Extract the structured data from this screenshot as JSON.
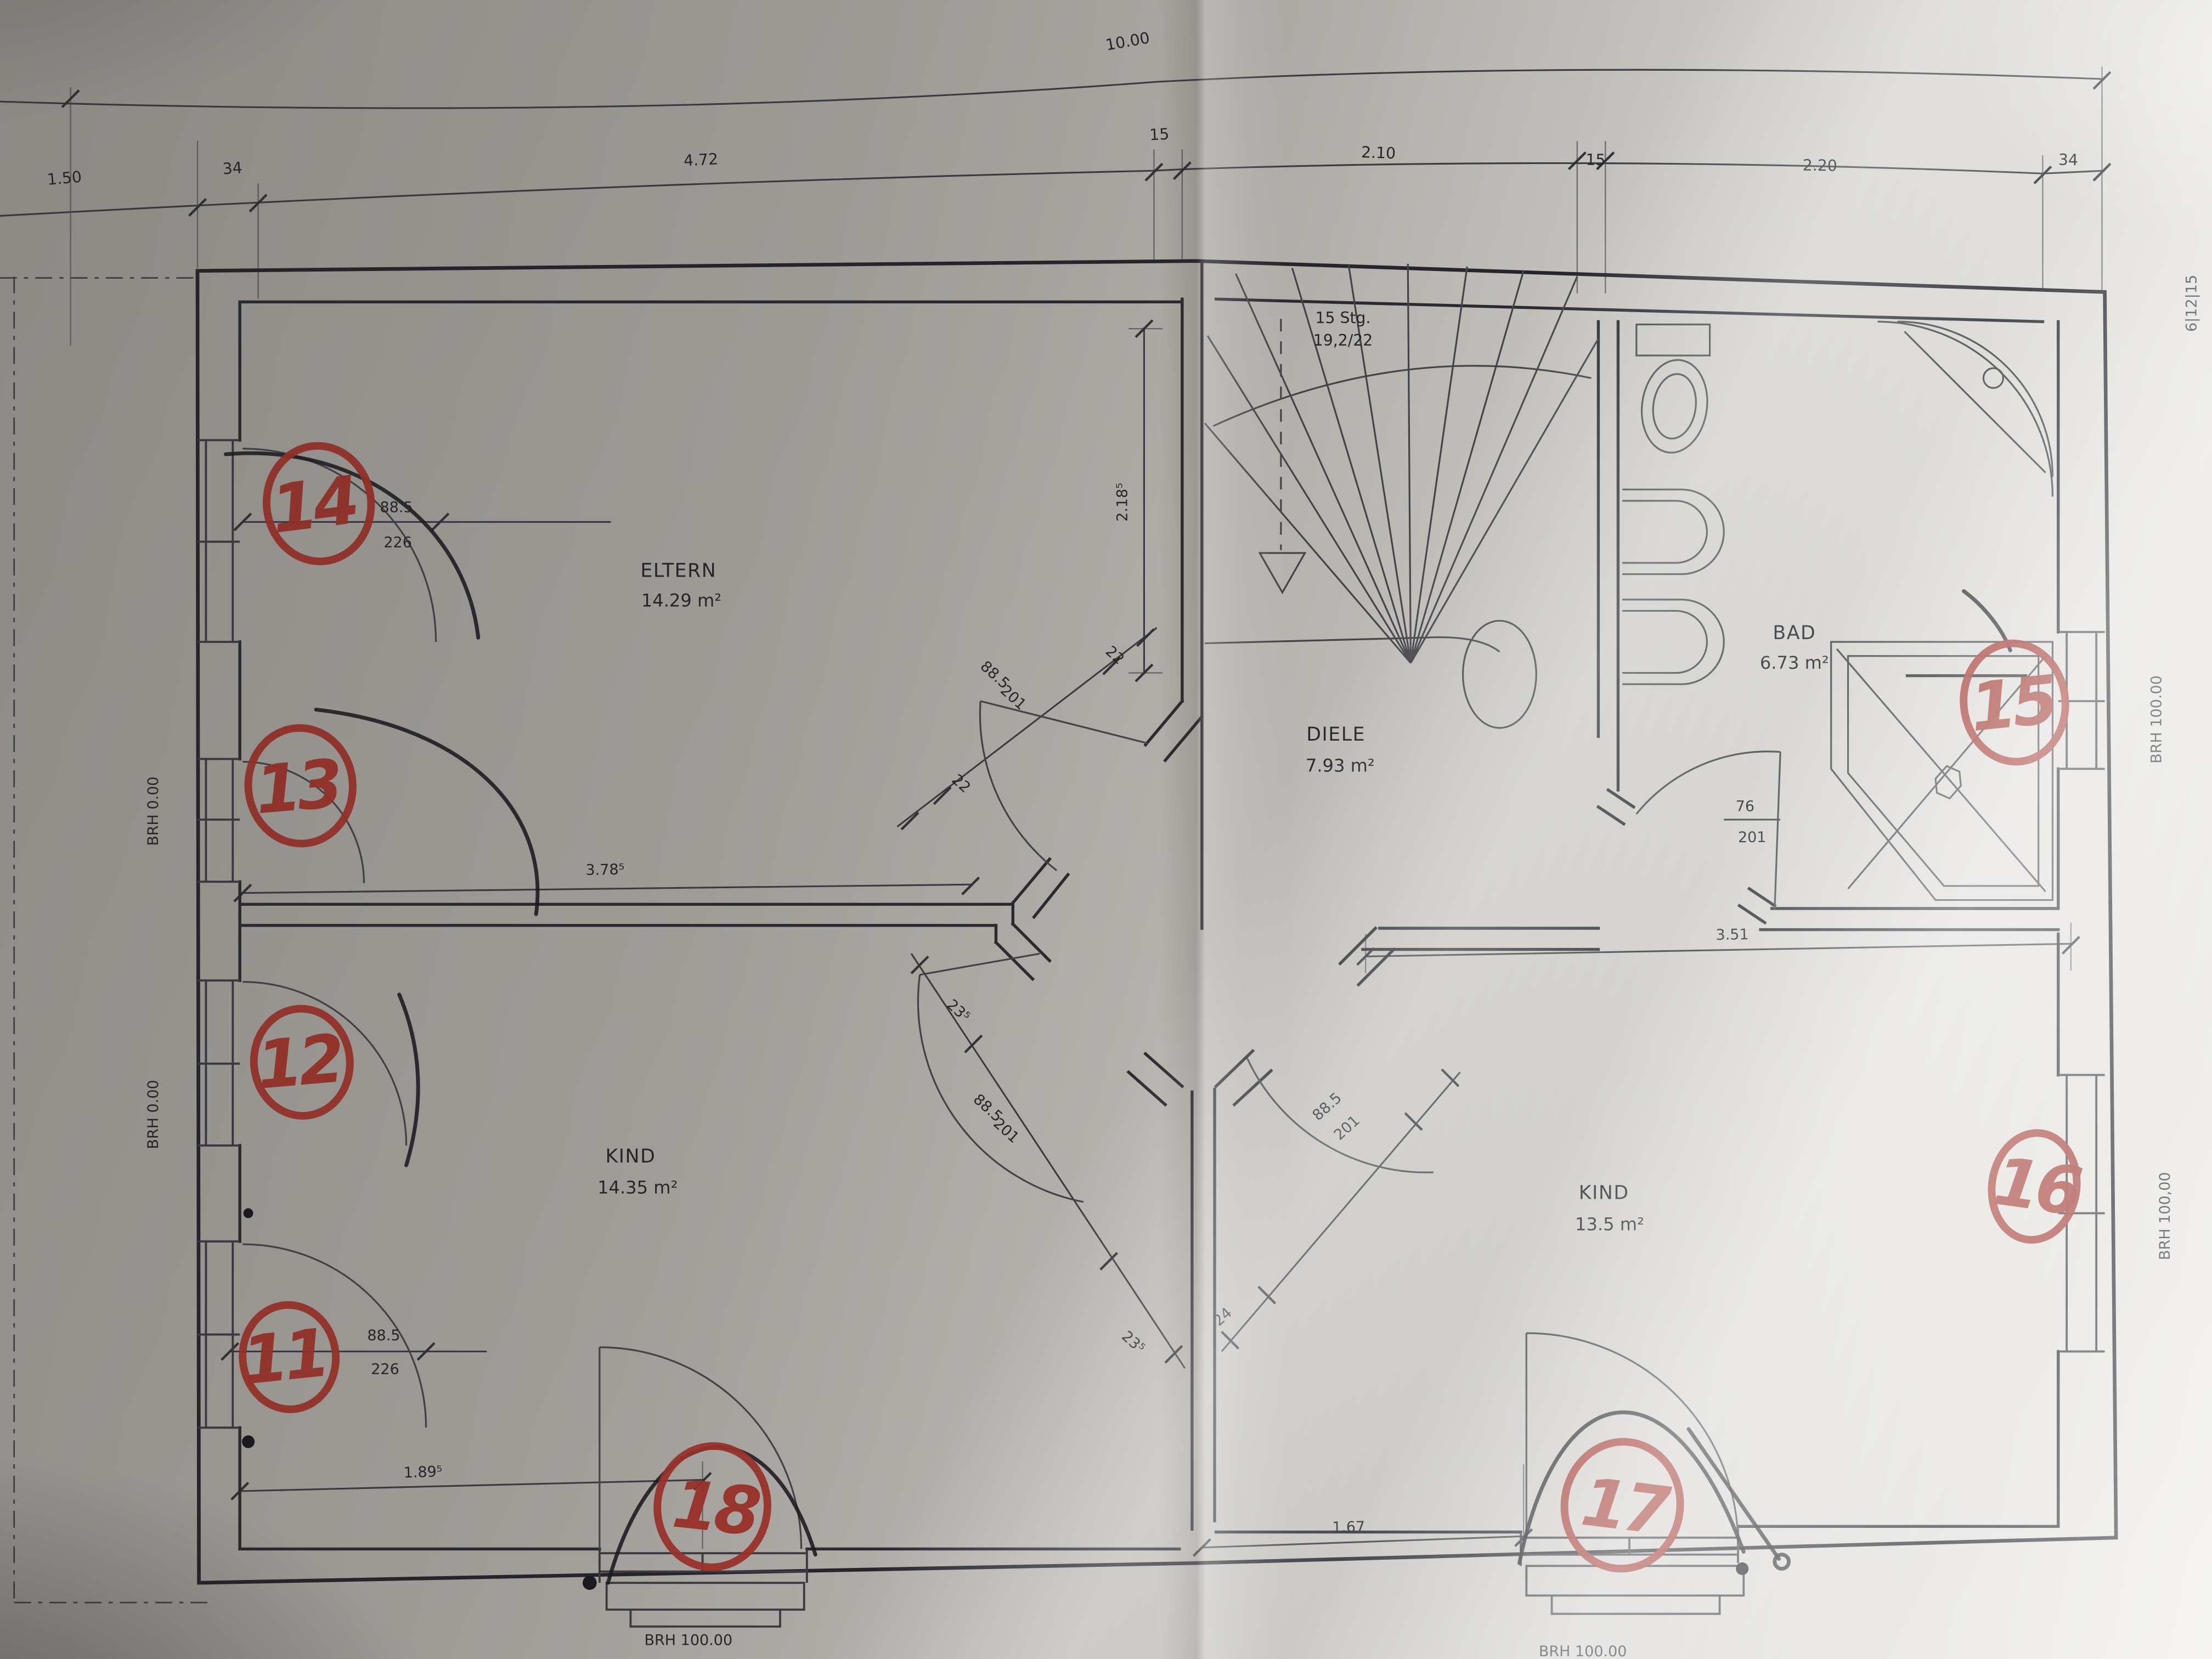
{
  "dims": {
    "total": "10.00",
    "left_offset": "1.50",
    "wall_34": "34",
    "span_472": "4.72",
    "wall_15": "15",
    "span_210": "2.10",
    "span_220": "2.20",
    "eltern_w": "3.78⁵",
    "eltern_h": "2.18⁵",
    "kind2_w": "3.51",
    "kind1_bottom": "1.89⁵",
    "kind2_bottom": "1.67",
    "jamb22": "22",
    "jamb235": "23⁵",
    "jamb24": "24"
  },
  "rooms": {
    "eltern": {
      "name": "ELTERN",
      "area": "14.29 m²"
    },
    "diele": {
      "name": "DIELE",
      "area": "7.93 m²"
    },
    "bad": {
      "name": "BAD",
      "area": "6.73 m²"
    },
    "kind1": {
      "name": "KIND",
      "area": "14.35 m²"
    },
    "kind2": {
      "name": "KIND",
      "area": "13.5 m²"
    }
  },
  "stairs": {
    "count": "15 Stg.",
    "ratio": "19,2/22"
  },
  "openings": {
    "balcony_door": {
      "w": "88.5",
      "h": "226"
    },
    "room_door": {
      "w": "88.5",
      "h": "201"
    },
    "bath_door": {
      "w": "76",
      "h": "201"
    }
  },
  "sills": {
    "left": "BRH 0.00",
    "right_top": "BRH 100.00",
    "right_bottom": "BRH 100,00",
    "bottom": "BRH 100.00"
  },
  "markers": {
    "m11": "11",
    "m12": "12",
    "m13": "13",
    "m14": "14",
    "m15": "15",
    "m16": "16",
    "m17": "17",
    "m18": "18"
  },
  "edge_note": "6|12|15",
  "colors": {
    "marker_red": "#9e332a",
    "ink": "#26252b",
    "paper": "#b4b1ad"
  }
}
